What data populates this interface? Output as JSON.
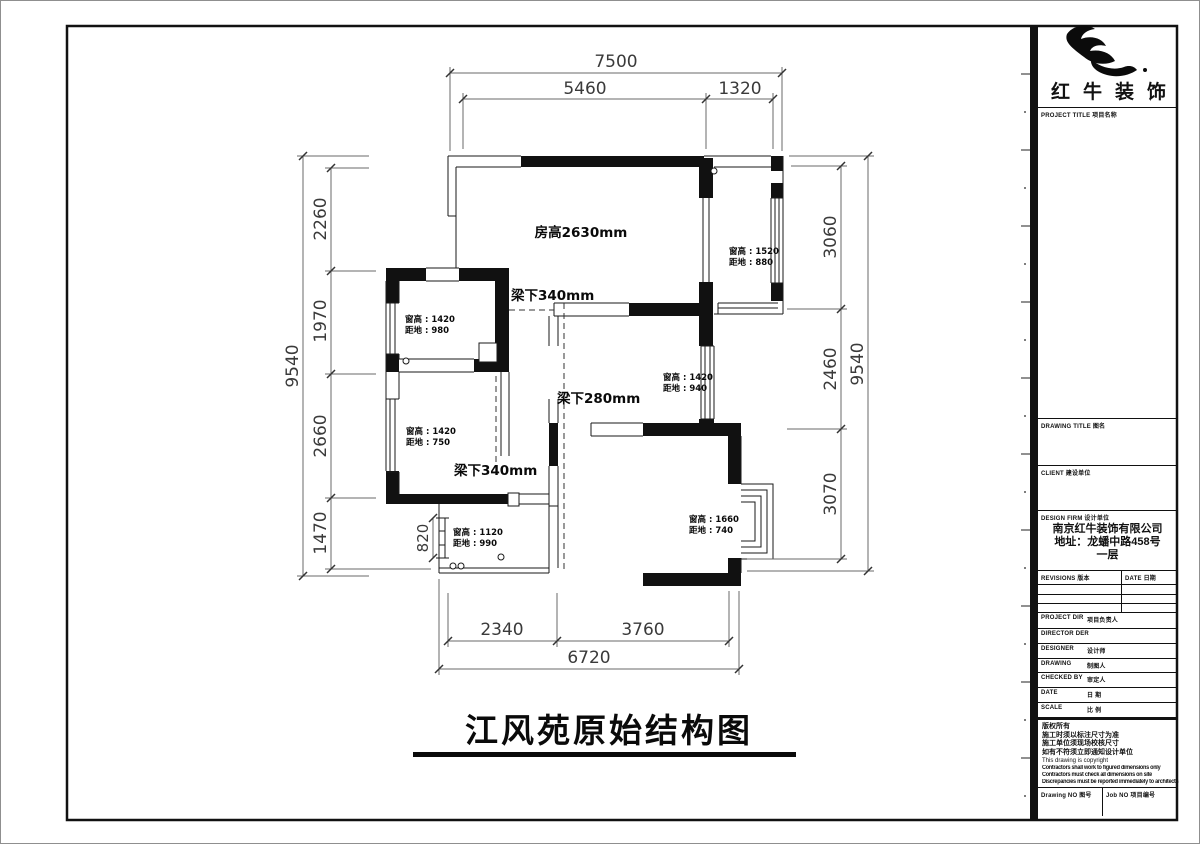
{
  "sheet": {
    "title": "江风苑原始结构图"
  },
  "colors": {
    "wall": "#111111",
    "line": "#1a1a1a",
    "dim_text": "#3a3a3a"
  },
  "plan": {
    "room_height": "房高2630mm",
    "beams": {
      "top": "梁下340mm",
      "middle": "梁下280mm",
      "bottom": "梁下340mm"
    },
    "windows": {
      "balcony": {
        "h": "窗高 : 1520",
        "s": "距地 : 880"
      },
      "room_tl": {
        "h": "窗高 : 1420",
        "s": "距地 : 980"
      },
      "room_mid": {
        "h": "窗高 : 1420",
        "s": "距地 : 940"
      },
      "room_ll": {
        "h": "窗高 : 1420",
        "s": "距地 : 750"
      },
      "kitchen": {
        "h": "窗高 : 1120",
        "s": "距地 : 990"
      },
      "bedroom": {
        "h": "窗高 : 1660",
        "s": "距地 : 740"
      }
    },
    "dims": {
      "top_total": "7500",
      "top_1": "5460",
      "top_2": "1320",
      "left_total": "9540",
      "left_1": "2260",
      "left_2": "1970",
      "left_3": "2660",
      "left_4": "1470",
      "right_1": "3060",
      "right_2": "2460",
      "right_3": "3070",
      "right_total": "9540",
      "bottom_1": "2340",
      "bottom_2": "3760",
      "bottom_total": "6720",
      "kitchen_window": "820"
    }
  },
  "titleblock": {
    "brand": "红牛装饰",
    "project_title_label": {
      "en": "PROJECT TITLE",
      "zh": "项目名称"
    },
    "drawing_title_label": {
      "en": "DRAWING TITLE",
      "zh": "图名"
    },
    "client_label": {
      "en": "CLIENT",
      "zh": "建设单位"
    },
    "design_firm_label": {
      "en": "DESIGN FIRM",
      "zh": "设计单位"
    },
    "firm_name": "南京红牛装饰有限公司",
    "firm_address": "地址：龙蟠中路458号一层",
    "revisions_label": {
      "en": "REVISIONS",
      "zh": "版本"
    },
    "date_col_label": {
      "en": "DATE",
      "zh": "日期"
    },
    "staff_rows": [
      {
        "en": "PROJECT DIR",
        "zh": "项目负责人"
      },
      {
        "en": "DIRECTOR DER",
        "zh": ""
      },
      {
        "en": "DESIGNER",
        "zh": "设计师"
      },
      {
        "en": "DRAWING",
        "zh": "制图人"
      },
      {
        "en": "CHECKED BY",
        "zh": "审定人"
      },
      {
        "en": "DATE",
        "zh": "日 期"
      },
      {
        "en": "SCALE",
        "zh": "比 例"
      }
    ],
    "notes": [
      "版权所有",
      "施工时须以标注尺寸为准",
      "施工单位须现场校核尺寸",
      "如有不符须立即通知设计单位",
      "This drawing is copyright",
      "Contractors shall work to figured dimensions only",
      "Contractors must check all dimensions on site",
      "Discrepancies must be reported immediately to architects"
    ],
    "drawing_no_label": {
      "en": "Drawing NO",
      "zh": "图号"
    },
    "job_no_label": {
      "en": "Job NO",
      "zh": "项目编号"
    }
  }
}
